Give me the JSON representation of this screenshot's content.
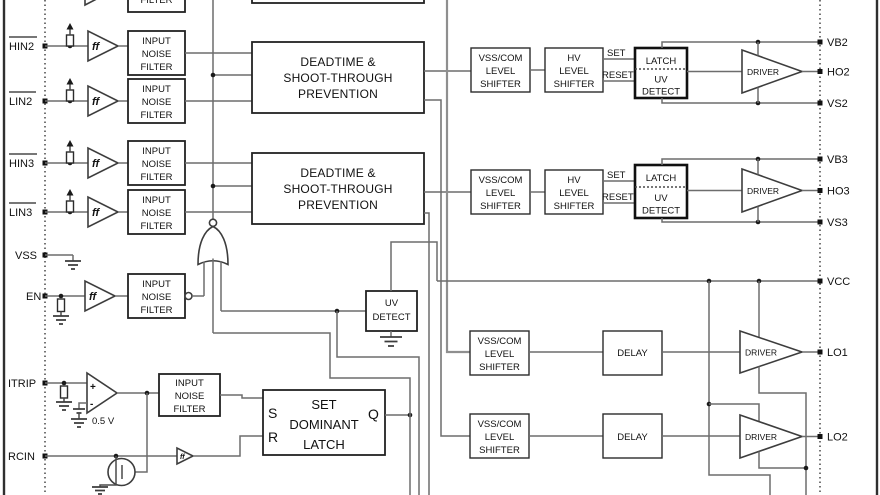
{
  "figure": {
    "description": "Gate driver IC functional block diagram (cropped view)",
    "bg_color": "#ffffff",
    "wire_color": "#6d6d6d",
    "box_color": "#222222"
  },
  "blocks": {
    "input_noise_filter": [
      "INPUT",
      "NOISE",
      "FILTER"
    ],
    "deadtime": [
      "DEADTIME &",
      "SHOOT-THROUGH",
      "PREVENTION"
    ],
    "vss_com_level_shifter": [
      "VSS/COM",
      "LEVEL",
      "SHIFTER"
    ],
    "hv_level_shifter": [
      "HV",
      "LEVEL",
      "SHIFTER"
    ],
    "latch": "LATCH",
    "uv_detect": [
      "UV",
      "DETECT"
    ],
    "delay": "DELAY",
    "driver": "DRIVER",
    "set_dominant_latch": [
      "SET",
      "DOMINANT",
      "LATCH"
    ]
  },
  "signals": {
    "set": "SET",
    "reset": "RESET",
    "s": "S",
    "r": "R",
    "q": "Q",
    "vref": "0.5 V",
    "buffer_glyph": "ff"
  },
  "pins": {
    "left": [
      {
        "label": "HIN2",
        "active_low": true
      },
      {
        "label": "LIN2",
        "active_low": true
      },
      {
        "label": "HIN3",
        "active_low": true
      },
      {
        "label": "LIN3",
        "active_low": true
      },
      {
        "label": "VSS",
        "active_low": false
      },
      {
        "label": "EN",
        "active_low": false
      },
      {
        "label": "ITRIP",
        "active_low": false
      },
      {
        "label": "RCIN",
        "active_low": false
      }
    ],
    "right": [
      "VB2",
      "HO2",
      "VS2",
      "VB3",
      "HO3",
      "VS3",
      "VCC",
      "LO1",
      "LO2"
    ]
  }
}
